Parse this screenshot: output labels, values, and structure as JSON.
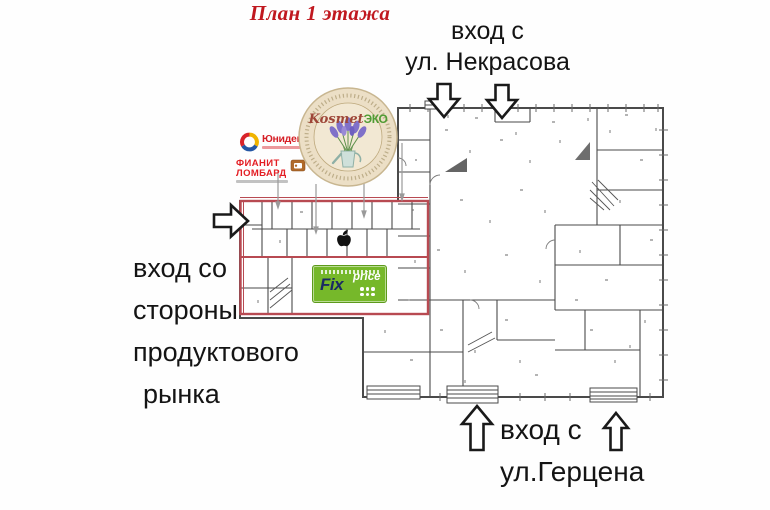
{
  "title": {
    "text": "План 1 этажа"
  },
  "entrances": {
    "nekrasova": {
      "lines": [
        "вход с",
        "ул. Некрасова"
      ]
    },
    "market": {
      "lines": [
        "вход со",
        "стороны",
        "продуктового",
        "рынка"
      ]
    },
    "gertsena": {
      "lines": [
        "вход с",
        "ул.Герцена"
      ]
    }
  },
  "tenant_logos": {
    "unidengi": {
      "name": "Юниденьги"
    },
    "fianit_lombard": {
      "line1": "ФИАНИТ",
      "line2": "ЛОМБАРД"
    },
    "kosmet_eco": {
      "name_part1": "Kosmet",
      "name_part2": "ЭКО"
    },
    "fix_price": {
      "word1": "Fix",
      "word2": "price"
    }
  },
  "icons": {
    "apple_logo_icon": "apple-silhouette",
    "arrow_down_icon": "block-arrow-down",
    "arrow_up_icon": "block-arrow-up",
    "arrow_right_icon": "block-arrow-right",
    "location_pin_icon": "leader-pin"
  },
  "colors": {
    "title_red": "#c0181f",
    "plan_lines": "#4a4a4a",
    "highlight_outline": "#b84a52",
    "fix_green": "#76b82a",
    "fix_navy": "#1b2a63",
    "unidengi_red": "#d61f26",
    "fianit_red": "#e31e24",
    "kosmet_beige": "#ecdfc6",
    "label_black": "#141414"
  }
}
